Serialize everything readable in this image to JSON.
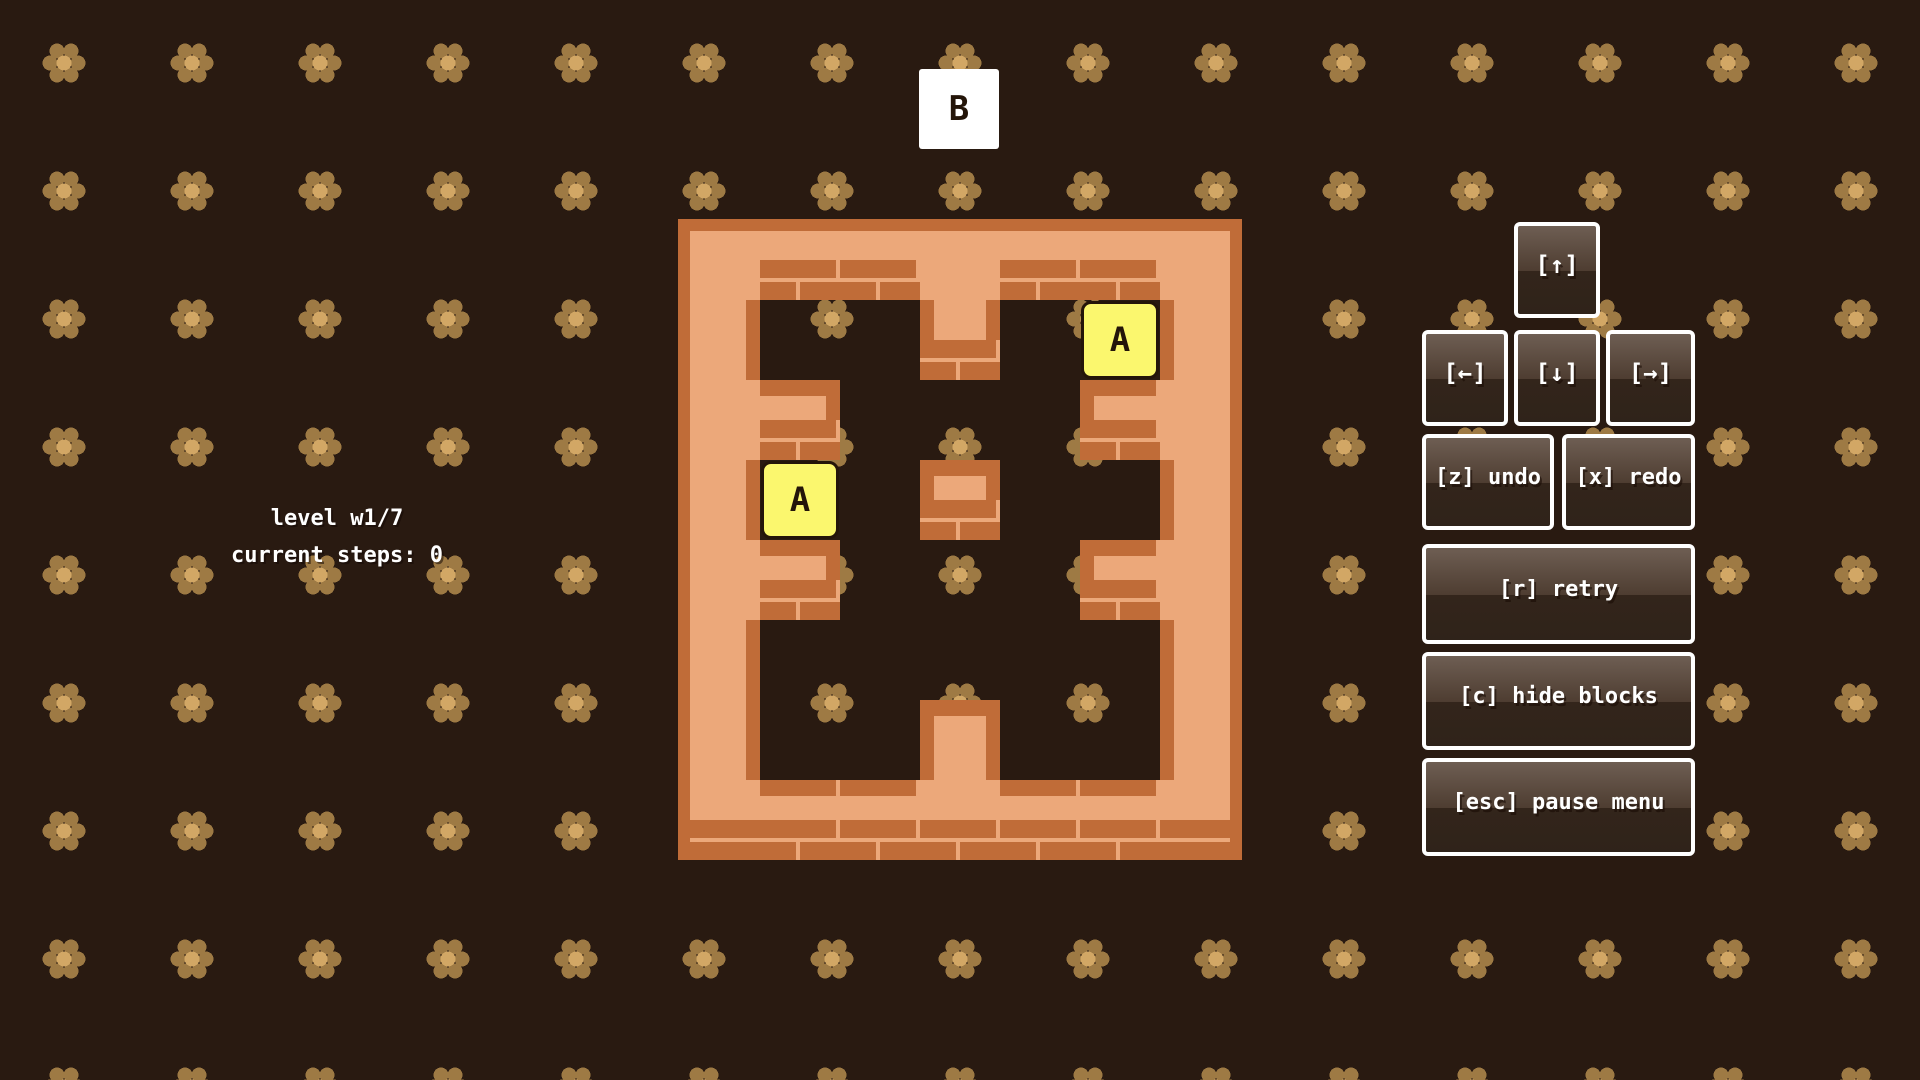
{
  "hud": {
    "level_label": "level w1/7",
    "steps_label": "current steps: 0",
    "current_steps": 0
  },
  "level": {
    "name": "w1/7",
    "grid": [
      "#######",
      "#..#..#",
      "##...##",
      "#..#..#",
      "##...##",
      "#.....#",
      "#..#..#",
      "#######"
    ],
    "blocks": [
      {
        "label": "A",
        "col": 1,
        "row": 3
      },
      {
        "label": "A",
        "col": 5,
        "row": 1
      }
    ]
  },
  "outside_block": {
    "label": "B"
  },
  "buttons": {
    "up": {
      "label": "[↑]",
      "key": "up-arrow"
    },
    "left": {
      "label": "[←]",
      "key": "left-arrow"
    },
    "down": {
      "label": "[↓]",
      "key": "down-arrow"
    },
    "right": {
      "label": "[→]",
      "key": "right-arrow"
    },
    "undo": {
      "label": "[z] undo",
      "key": "z"
    },
    "redo": {
      "label": "[x] redo",
      "key": "x"
    },
    "retry": {
      "label": "[r] retry",
      "key": "r"
    },
    "hide": {
      "label": "[c] hide blocks",
      "key": "c"
    },
    "pause": {
      "label": "[esc] pause menu",
      "key": "esc"
    }
  },
  "colors": {
    "background": "#291a11",
    "wall": "#eca87a",
    "brick": "#c06c38",
    "flower_petal": "#9e7a44",
    "flower_center": "#d2a765",
    "block_yellow": "#fbf76e",
    "block_white": "#ffffff",
    "button_border": "#ffffff",
    "text": "#ffffff"
  }
}
